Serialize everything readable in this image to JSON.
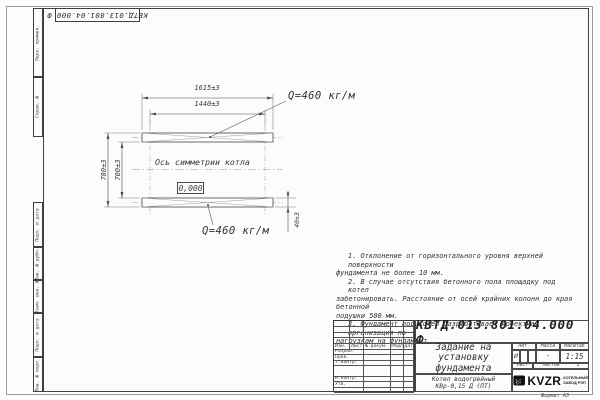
{
  "doc": {
    "number": "КВТД.013.801.04.000 Ф"
  },
  "colors": {
    "line": "#4a4a4a",
    "logo": "#111111",
    "paper": "#fcfcfb"
  },
  "drawing": {
    "dims": {
      "overall_width": "1615±3",
      "inner_width": "1440±3",
      "outer_height": "780±3",
      "inner_height": "700±3",
      "pad_thickness": "40±3"
    },
    "labels": {
      "load_top": "Q=460 кг/м",
      "load_bottom": "Q=460 кг/м",
      "symmetry_axis": "Ось симметрии котла",
      "elevation": "0,000"
    }
  },
  "notes": {
    "lines": [
      "1. Отклонение от горизонтального уровня верхней поверхности",
      "фундамента не более 10 мм.",
      "2. В случае отсутствия бетонного пола площадку под котел",
      "забетонировать. Расстояние от осей крайних колонн до края бетонной",
      "подушки 500 мм.",
      "3. Фундамент под котел разрабатывает проектная организация по",
      "нагрузкам на фундамент."
    ]
  },
  "side_strip": {
    "items": [
      "Перв. примен.",
      "Справ. №",
      "Подп. и дата",
      "Инв. № дубл.",
      "Взам. инв. №",
      "Подп. и дата",
      "Инв. № подл."
    ]
  },
  "title_block": {
    "designation": "КВТД.013.801.04.000 Ф",
    "title": {
      "line1": "Задание на",
      "line2": "установку",
      "line3": "фундамента"
    },
    "cols": {
      "izm": "Изм.",
      "list": "Лист",
      "doc": "№ докум.",
      "podp": "Подп.",
      "data": "Дата"
    },
    "rows": {
      "razrab": "Разраб.",
      "prov": "Пров.",
      "tkontr": "Т.контр.",
      "nkontr": "Н.контр.",
      "utv": "Утв."
    },
    "lit": {
      "label": "Лит.",
      "value": "И"
    },
    "mass": {
      "label": "Масса",
      "value": "-"
    },
    "scale": {
      "label": "Масштаб",
      "value": "1:15"
    },
    "sheet": {
      "label": "Лист"
    },
    "sheets": {
      "label": "Листов",
      "value": "1"
    },
    "product": {
      "line1": "Котел водогрейный",
      "line2": "КВр-0,15 Д (ПТ)"
    },
    "company": {
      "name": "KVZR",
      "sub1": "КОТЕЛЬНЫЙ",
      "sub2": "ЗАВОД РЭП"
    },
    "format_label": "Формат А3"
  }
}
